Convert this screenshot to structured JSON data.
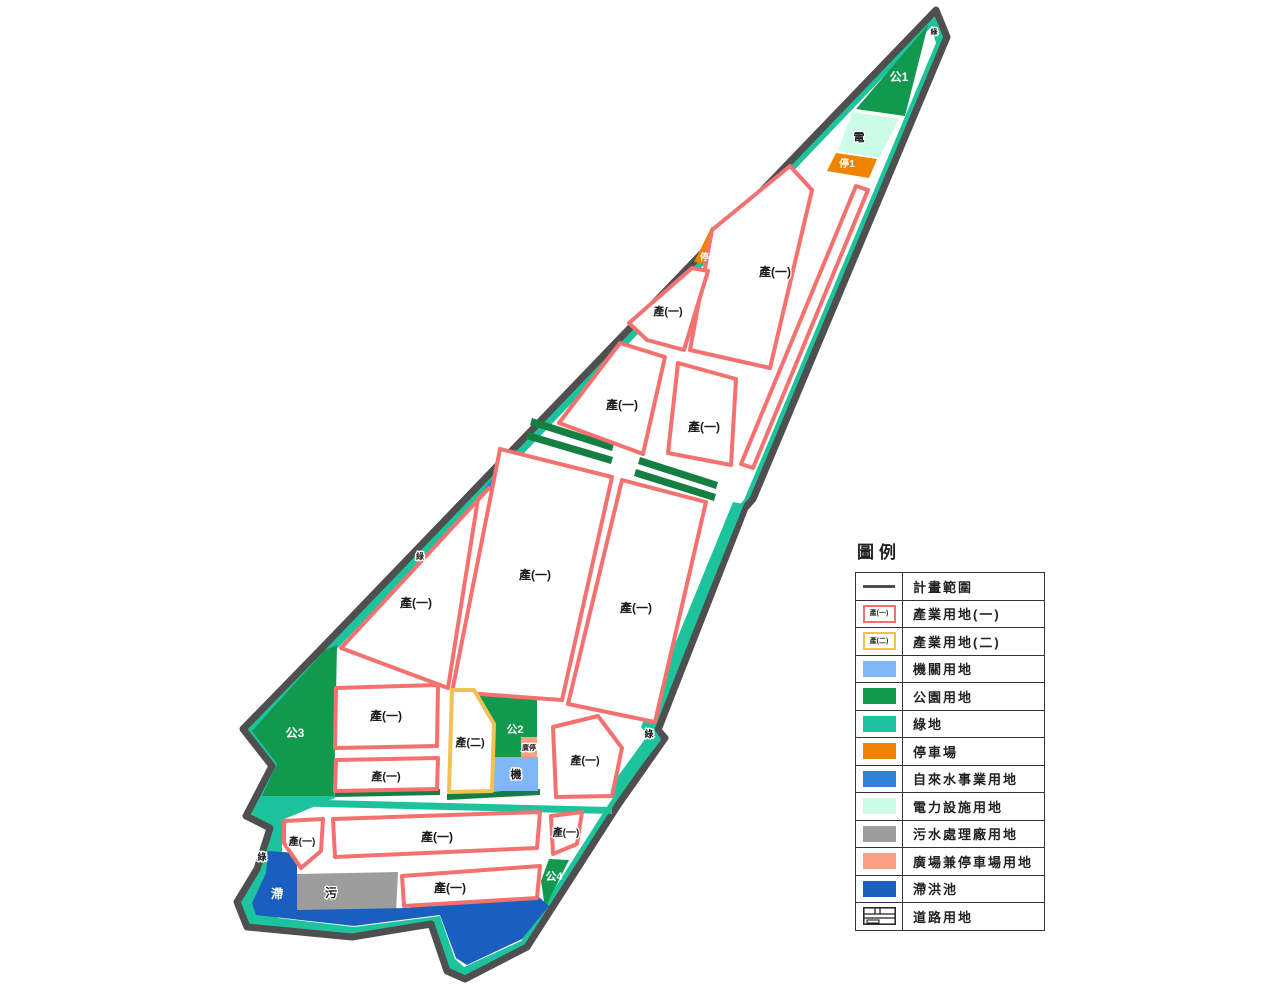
{
  "legend": {
    "title": "圖例",
    "items": [
      {
        "symbol": "line",
        "label": "計畫範圍"
      },
      {
        "symbol": "parcel1",
        "swatch_text": "產(一)",
        "label": "產業用地(一)"
      },
      {
        "symbol": "parcel2",
        "swatch_text": "產(二)",
        "label": "產業用地(二)"
      },
      {
        "symbol": "fill",
        "color": "#80b7f8",
        "label": "機關用地"
      },
      {
        "symbol": "fill",
        "color": "#12994f",
        "label": "公園用地"
      },
      {
        "symbol": "fill",
        "color": "#1dc39c",
        "label": "綠地"
      },
      {
        "symbol": "fill",
        "color": "#f08300",
        "label": "停車場"
      },
      {
        "symbol": "fill",
        "color": "#2e80da",
        "label": "自來水事業用地"
      },
      {
        "symbol": "fill",
        "color": "#ccfbe7",
        "label": "電力設施用地"
      },
      {
        "symbol": "fill",
        "color": "#9d9d9d",
        "label": "污水處理廠用地"
      },
      {
        "symbol": "fill",
        "color": "#fca183",
        "label": "廣場兼停車場用地"
      },
      {
        "symbol": "fill",
        "color": "#1a5fc0",
        "label": "滯洪池"
      },
      {
        "symbol": "road",
        "label": "道路用地"
      }
    ]
  },
  "map": {
    "labels": [
      {
        "name": "green-tip",
        "text": "綠",
        "x": 934,
        "y": 34,
        "color": "#1a1a1a",
        "size": 7
      },
      {
        "name": "park-1",
        "text": "公1",
        "x": 899,
        "y": 81,
        "color": "#ffffff",
        "size": 12
      },
      {
        "name": "power",
        "text": "電",
        "x": 859,
        "y": 141,
        "color": "#1a1a1a",
        "size": 11
      },
      {
        "name": "parking-1",
        "text": "停1",
        "x": 847,
        "y": 167,
        "color": "#ffffff",
        "size": 10
      },
      {
        "name": "parking-2",
        "text": "停2",
        "x": 707,
        "y": 260,
        "color": "#ffffff",
        "size": 9
      },
      {
        "name": "ind1-a",
        "text": "產(一)",
        "x": 775,
        "y": 276,
        "color": "#1a1a1a",
        "size": 12
      },
      {
        "name": "ind1-b",
        "text": "產(一)",
        "x": 668,
        "y": 315,
        "color": "#1a1a1a",
        "size": 11
      },
      {
        "name": "ind1-c",
        "text": "產(一)",
        "x": 622,
        "y": 409,
        "color": "#1a1a1a",
        "size": 12
      },
      {
        "name": "ind1-d",
        "text": "產(一)",
        "x": 704,
        "y": 431,
        "color": "#1a1a1a",
        "size": 12
      },
      {
        "name": "water",
        "text": "水",
        "x": 506,
        "y": 489,
        "color": "#ffffff",
        "size": 11
      },
      {
        "name": "green-left",
        "text": "綠",
        "x": 420,
        "y": 559,
        "color": "#1a1a1a",
        "size": 8
      },
      {
        "name": "ind1-e",
        "text": "產(一)",
        "x": 535,
        "y": 579,
        "color": "#1a1a1a",
        "size": 12
      },
      {
        "name": "ind1-f",
        "text": "產(一)",
        "x": 636,
        "y": 612,
        "color": "#1a1a1a",
        "size": 12
      },
      {
        "name": "ind1-g",
        "text": "產(一)",
        "x": 416,
        "y": 607,
        "color": "#1a1a1a",
        "size": 12
      },
      {
        "name": "park-3",
        "text": "公3",
        "x": 295,
        "y": 737,
        "color": "#ffffff",
        "size": 12
      },
      {
        "name": "ind1-h",
        "text": "產(一)",
        "x": 386,
        "y": 720,
        "color": "#1a1a1a",
        "size": 12
      },
      {
        "name": "ind1-i",
        "text": "產(一)",
        "x": 386,
        "y": 780,
        "color": "#1a1a1a",
        "size": 11
      },
      {
        "name": "ind2",
        "text": "產(二)",
        "x": 470,
        "y": 746,
        "color": "#1a1a1a",
        "size": 11
      },
      {
        "name": "park-2",
        "text": "公2",
        "x": 515,
        "y": 733,
        "color": "#ffffff",
        "size": 11
      },
      {
        "name": "plaza-parking",
        "text": "廣停",
        "x": 529,
        "y": 750,
        "color": "#1a1a1a",
        "size": 7
      },
      {
        "name": "institution",
        "text": "機",
        "x": 516,
        "y": 778,
        "color": "#1a1a1a",
        "size": 11
      },
      {
        "name": "ind1-j",
        "text": "產(一)",
        "x": 585,
        "y": 764,
        "color": "#1a1a1a",
        "size": 11
      },
      {
        "name": "green-right",
        "text": "綠",
        "x": 649,
        "y": 737,
        "color": "#1a1a1a",
        "size": 9
      },
      {
        "name": "ind1-k",
        "text": "產(一)",
        "x": 302,
        "y": 845,
        "color": "#1a1a1a",
        "size": 10
      },
      {
        "name": "ind1-l",
        "text": "產(一)",
        "x": 437,
        "y": 841,
        "color": "#1a1a1a",
        "size": 12
      },
      {
        "name": "ind1-m",
        "text": "產(一)",
        "x": 566,
        "y": 836,
        "color": "#1a1a1a",
        "size": 10
      },
      {
        "name": "park-4",
        "text": "公4",
        "x": 554,
        "y": 880,
        "color": "#ffffff",
        "size": 11
      },
      {
        "name": "sewage",
        "text": "污",
        "x": 331,
        "y": 897,
        "color": "#1a1a1a",
        "size": 12
      },
      {
        "name": "ind1-n",
        "text": "產(一)",
        "x": 450,
        "y": 892,
        "color": "#1a1a1a",
        "size": 12
      },
      {
        "name": "detention",
        "text": "滯",
        "x": 277,
        "y": 898,
        "color": "#ffffff",
        "size": 12
      },
      {
        "name": "green-bottom",
        "text": "綠",
        "x": 262,
        "y": 860,
        "color": "#1a1a1a",
        "size": 9
      }
    ]
  },
  "colors": {
    "plan_boundary": "#4f4f4f",
    "green_space": "#1dc39c",
    "park": "#12994f",
    "road_green_strip": "#157f43",
    "industrial_1_border": "#f4716f",
    "industrial_2_border": "#f2c151",
    "institution": "#80b7f8",
    "parking": "#f08300",
    "water_utility": "#2e80da",
    "power_facility": "#ccfbe7",
    "sewage_plant": "#9d9d9d",
    "plaza_parking": "#fca183",
    "detention_pond": "#1a5fc0"
  }
}
